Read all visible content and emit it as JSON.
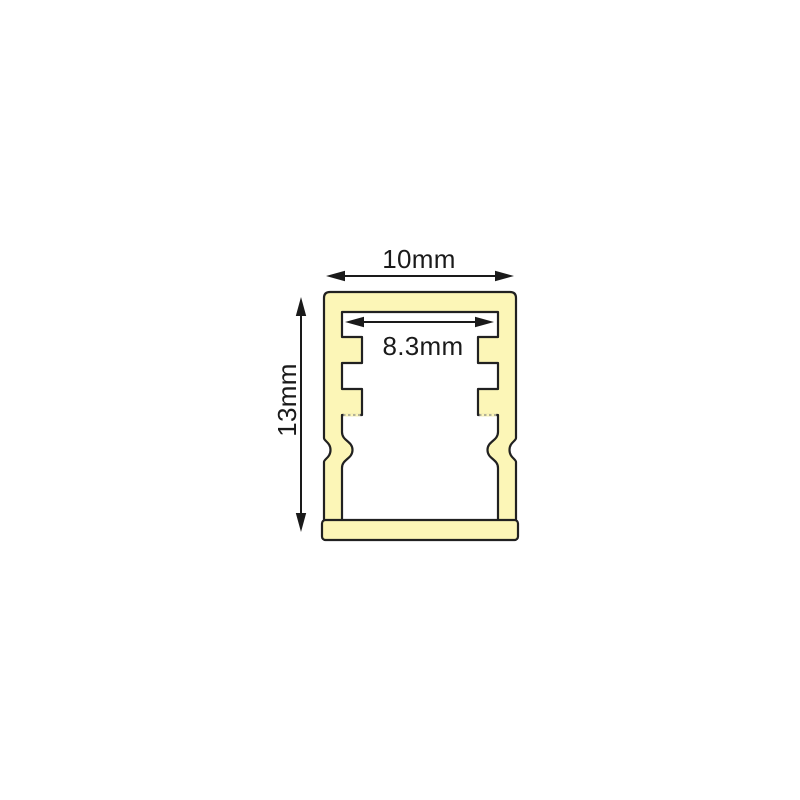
{
  "diagram": {
    "kind": "profile-cross-section",
    "dimensions": {
      "outer_width": {
        "label": "10mm"
      },
      "inner_width": {
        "label": "8.3mm"
      },
      "height": {
        "label": "13mm"
      }
    },
    "colors": {
      "profile_fill": "#FCF6B7",
      "profile_outline": "#212121",
      "dimension_lines": "#1A1A1A",
      "hidden_edge_dotted": "#9A9A8E",
      "background": "#FFFFFF"
    }
  }
}
